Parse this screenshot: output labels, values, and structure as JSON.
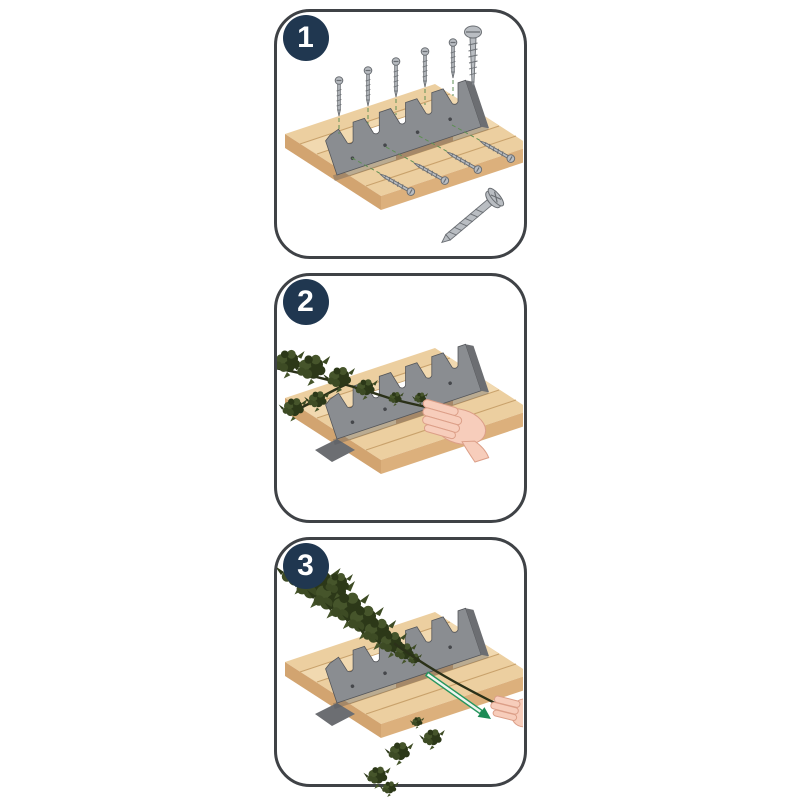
{
  "page": {
    "background": "#ffffff",
    "description": "three-step-assembly-instructions"
  },
  "colors": {
    "panel_border": "#3f4246",
    "badge_bg": "#203750",
    "number_color": "#ffffff",
    "wood_top": "#eccfa0",
    "wood_light": "#f6e2bd",
    "wood_line": "#c9a26c",
    "wood_side": "#dcb07c",
    "wood_side_dark": "#d2a470",
    "comb_face": "#8a8d91",
    "comb_side": "#6c6e72",
    "comb_dark": "#54565a",
    "comb_dot": "#45474b",
    "screw": "#b9bdc2",
    "screw_dark": "#6a6e73",
    "dash_green": "#5f8f55",
    "leaf": "#3d4b24",
    "leaf_dark": "#2c3818",
    "leaf_light": "#46552b",
    "stem": "#2b3119",
    "skin": "#f7cdbb",
    "skin_line": "#dc9f88",
    "arrow_green": "#27965f",
    "arrow_fill": "#eef6f0",
    "arrow_head": "#1d8a55"
  },
  "steps": [
    {
      "number": "1",
      "illustration": "screw-comb-bracket-onto-board",
      "elements": [
        "wood-board-with-opening",
        "serrated-comb-bracket",
        "mounting-screws",
        "screw-icon-round-head",
        "screw-icon-countersunk-head"
      ]
    },
    {
      "number": "2",
      "illustration": "lay-branch-into-comb-notch",
      "elements": [
        "wood-board-with-opening",
        "serrated-comb-bracket",
        "leafy-branch",
        "hand-pressing-branch"
      ]
    },
    {
      "number": "3",
      "illustration": "pull-branch-through-comb",
      "elements": [
        "wood-board-with-opening",
        "serrated-comb-bracket",
        "stripped-leaf-pile",
        "stripped-stem",
        "pull-direction-arrow",
        "hand-pulling-stem",
        "falling-leaves"
      ]
    }
  ]
}
